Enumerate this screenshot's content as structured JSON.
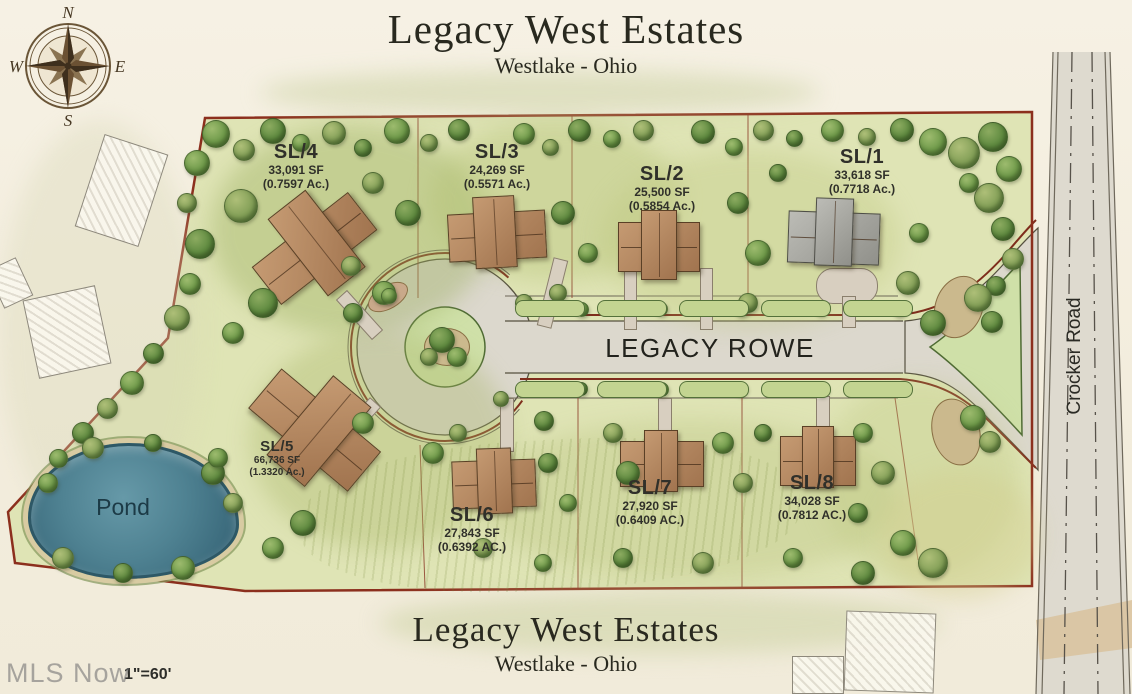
{
  "header": {
    "title": "Legacy West Estates",
    "subtitle": "Westlake - Ohio"
  },
  "footer": {
    "title": "Legacy West Estates",
    "subtitle": "Westlake - Ohio"
  },
  "compass": {
    "north": "N",
    "east": "E",
    "south": "S",
    "west": "W"
  },
  "map": {
    "street_label": "LEGACY ROWE",
    "side_road_label": "Crocker Road",
    "pond_label": "Pond",
    "scale_label": "1\"=60'",
    "watermark": "MLS Now"
  },
  "lots": [
    {
      "id": "SL/1",
      "area_sf": "33,618 SF",
      "area_ac": "(0.7718 Ac.)"
    },
    {
      "id": "SL/2",
      "area_sf": "25,500 SF",
      "area_ac": "(0.5854 Ac.)"
    },
    {
      "id": "SL/3",
      "area_sf": "24,269 SF",
      "area_ac": "(0.5571 Ac.)"
    },
    {
      "id": "SL/4",
      "area_sf": "33,091 SF",
      "area_ac": "(0.7597 Ac.)"
    },
    {
      "id": "SL/5",
      "area_sf": "66,736 SF",
      "area_ac": "(1.3320 Ac.)"
    },
    {
      "id": "SL/6",
      "area_sf": "27,843 SF",
      "area_ac": "(0.6392 AC.)"
    },
    {
      "id": "SL/7",
      "area_sf": "27,920 SF",
      "area_ac": "(0.6409 AC.)"
    },
    {
      "id": "SL/8",
      "area_sf": "34,028 SF",
      "area_ac": "(0.7812 AC.)"
    }
  ],
  "colors": {
    "boundary": "#8c2f1d",
    "road": "#dcd8cd",
    "grass": "#dfe4b5",
    "pond": "#4f8292",
    "tree": "#6f9a4a"
  }
}
